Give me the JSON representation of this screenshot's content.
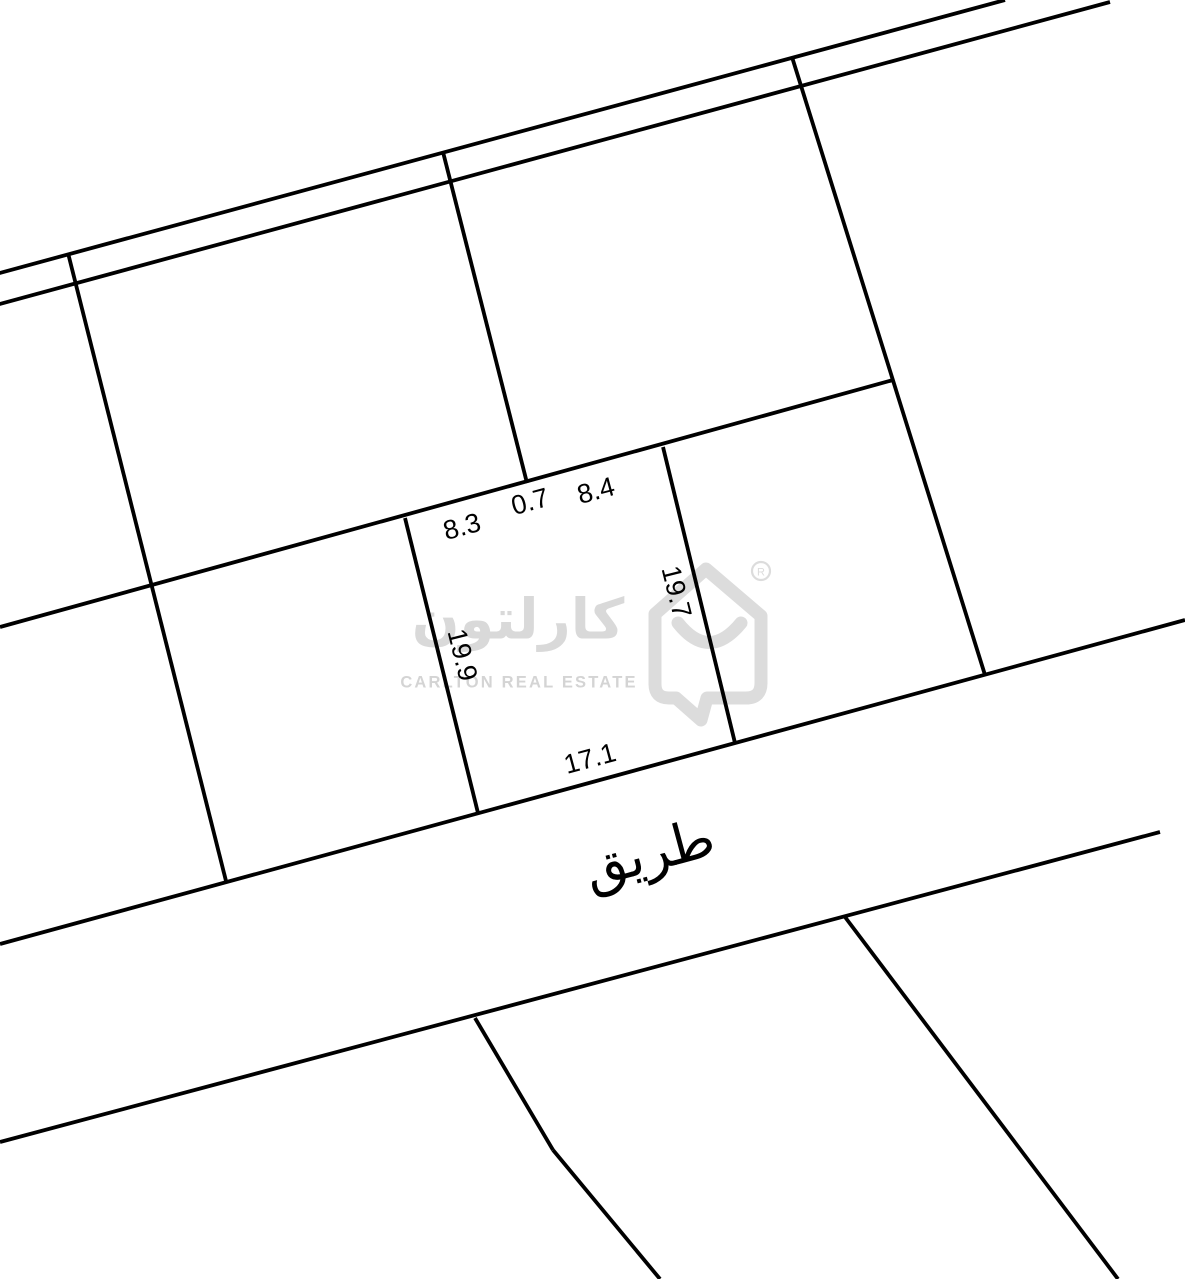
{
  "map": {
    "style": {
      "background": "#ffffff",
      "line_color": "#000000",
      "line_width": 3.8,
      "watermark_color": "#d9d9d9"
    },
    "labels": [
      {
        "text": "8.3",
        "x": 462,
        "y": 527,
        "rot": -15,
        "size": 27
      },
      {
        "text": "0.7",
        "x": 530,
        "y": 502,
        "rot": -15,
        "size": 27
      },
      {
        "text": "8.4",
        "x": 596,
        "y": 491,
        "rot": -15,
        "size": 27
      },
      {
        "text": "19.7",
        "x": 676,
        "y": 592,
        "rot": 76,
        "size": 27
      },
      {
        "text": "19.9",
        "x": 462,
        "y": 655,
        "rot": 76,
        "size": 27
      },
      {
        "text": "17.1",
        "x": 590,
        "y": 759,
        "rot": -15,
        "size": 27
      },
      {
        "text": "طريق",
        "x": 649,
        "y": 853,
        "rot": -15,
        "size": 54
      }
    ],
    "segments": [
      {
        "name": "upper-lane-top-edge",
        "x1": -4,
        "y1": 274,
        "x2": 1005,
        "y2": 0
      },
      {
        "name": "upper-lane-bottom-edge",
        "x1": -4,
        "y1": 305,
        "x2": 1110,
        "y2": 2
      },
      {
        "name": "upper-left-boundary",
        "x1": 68,
        "y1": 253,
        "x2": 226,
        "y2": 881
      },
      {
        "name": "notch-boundary",
        "x1": 443,
        "y1": 152,
        "x2": 527,
        "y2": 483
      },
      {
        "name": "upper-right-boundary",
        "x1": 792,
        "y1": 57,
        "x2": 985,
        "y2": 675
      },
      {
        "name": "upper-plots-front-line",
        "x1": 0,
        "y1": 627,
        "x2": 893,
        "y2": 380
      },
      {
        "name": "plot-left-edge",
        "x1": 405,
        "y1": 518,
        "x2": 478,
        "y2": 813
      },
      {
        "name": "plot-right-edge",
        "x1": 663,
        "y1": 447,
        "x2": 735,
        "y2": 743
      },
      {
        "name": "road-upper-edge",
        "x1": 0,
        "y1": 944,
        "x2": 1185,
        "y2": 620
      },
      {
        "name": "road-lower-edge",
        "x1": 0,
        "y1": 1142,
        "x2": 1160,
        "y2": 832
      },
      {
        "name": "lower-right-boundary",
        "x1": 845,
        "y1": 917,
        "x2": 1118,
        "y2": 1279
      },
      {
        "name": "lower-left-boundary-a",
        "x1": 475,
        "y1": 1018,
        "x2": 553,
        "y2": 1150
      },
      {
        "name": "lower-left-boundary-b",
        "x1": 553,
        "y1": 1150,
        "x2": 660,
        "y2": 1279
      }
    ]
  },
  "watermark": {
    "arabic": "كارلتون",
    "latin": "CARLTON REAL ESTATE",
    "registered": "R"
  }
}
